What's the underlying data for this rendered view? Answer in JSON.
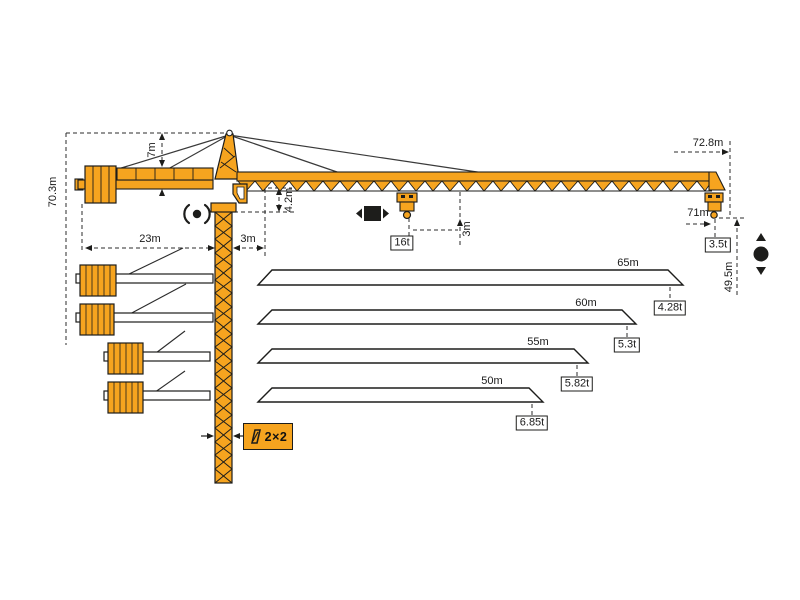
{
  "diagram": {
    "colors": {
      "crane_orange": "#F6A41F",
      "outline": "#1d1d1b",
      "dimension_line": "#2b2b2b"
    },
    "dimensions": {
      "total_height": "70.3m",
      "tower_head_height": "7m",
      "counter_jib_radius": "23m",
      "rear_offset": "3m",
      "jib_section_height": "4.2m",
      "min_hook_offset": "3m",
      "jib_overall_length": "72.8m",
      "max_working_radius": "71m",
      "lift_height": "49.5m"
    },
    "loads": {
      "max_capacity": "16t",
      "tip_capacity": "3.5t"
    },
    "mast_section": {
      "label": "2×2"
    },
    "jib_options": [
      {
        "length": "65m",
        "tip_load": "4.28t"
      },
      {
        "length": "60m",
        "tip_load": "5.3t"
      },
      {
        "length": "55m",
        "tip_load": "5.82t"
      },
      {
        "length": "50m",
        "tip_load": "6.85t"
      }
    ],
    "symbols": {
      "slewing": "slewing-icon",
      "trolley_travel": "trolley-travel-icon",
      "hoisting": "hoist-icon",
      "mast_cross_section": "mast-section-icon"
    }
  }
}
